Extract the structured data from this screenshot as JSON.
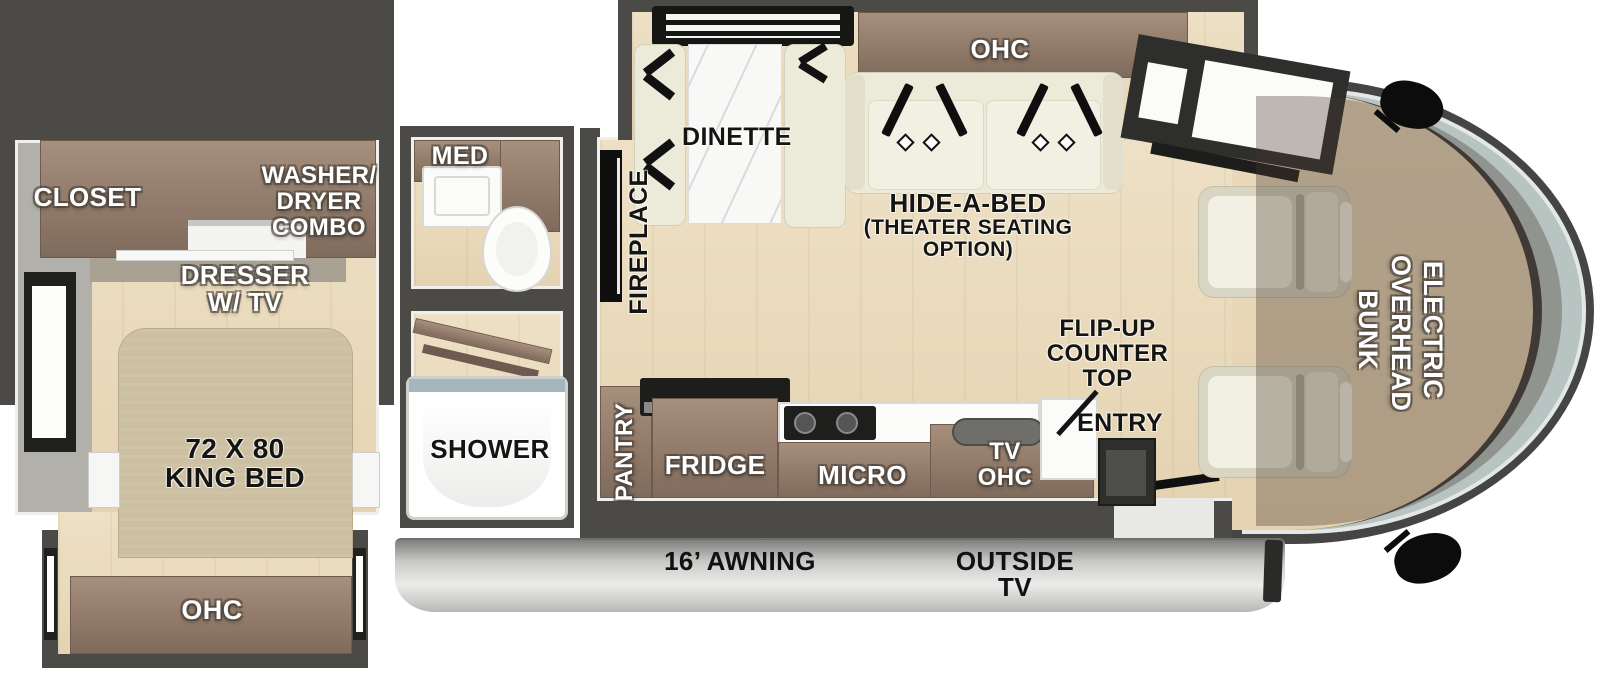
{
  "title": "RV floor plan",
  "colors": {
    "wall": "#4b4a46",
    "floor_wood": "#e9dabb",
    "cabinet_brown": "#937c6b",
    "bed_tan": "#cdc0a2",
    "sofa_cream": "#ecead9",
    "marble_white": "#f8f8f6",
    "windshield_glass": "#b7c4c2",
    "awning_silver": "#c9c9c7",
    "bunk_overlay": "rgba(70,57,43,0.34)",
    "label_white": "#ffffff",
    "label_black": "#141412"
  },
  "labels": {
    "closet": "CLOSET",
    "washer_dryer": [
      "WASHER/",
      "DRYER",
      "COMBO"
    ],
    "dresser": [
      "DRESSER",
      "W/ TV"
    ],
    "king_bed": [
      "72 X 80",
      "KING BED"
    ],
    "bedroom_ohc": "OHC",
    "med": "MED",
    "shower": "SHOWER",
    "fireplace": "FIREPLACE",
    "pantry": "PANTRY",
    "dinette": "DINETTE",
    "living_ohc": "OHC",
    "hide_a_bed": [
      "HIDE-A-BED",
      "(THEATER SEATING",
      "OPTION)"
    ],
    "fridge": "FRIDGE",
    "micro": "MICRO",
    "tv_ohc": [
      "TV",
      "OHC"
    ],
    "flip_up_counter": [
      "FLIP-UP",
      "COUNTER",
      "TOP"
    ],
    "entry": "ENTRY",
    "overhead_bunk": [
      "ELECTRIC",
      "OVERHEAD",
      "BUNK"
    ],
    "awning": "16’ AWNING",
    "outside_tv": [
      "OUTSIDE",
      "TV"
    ]
  }
}
